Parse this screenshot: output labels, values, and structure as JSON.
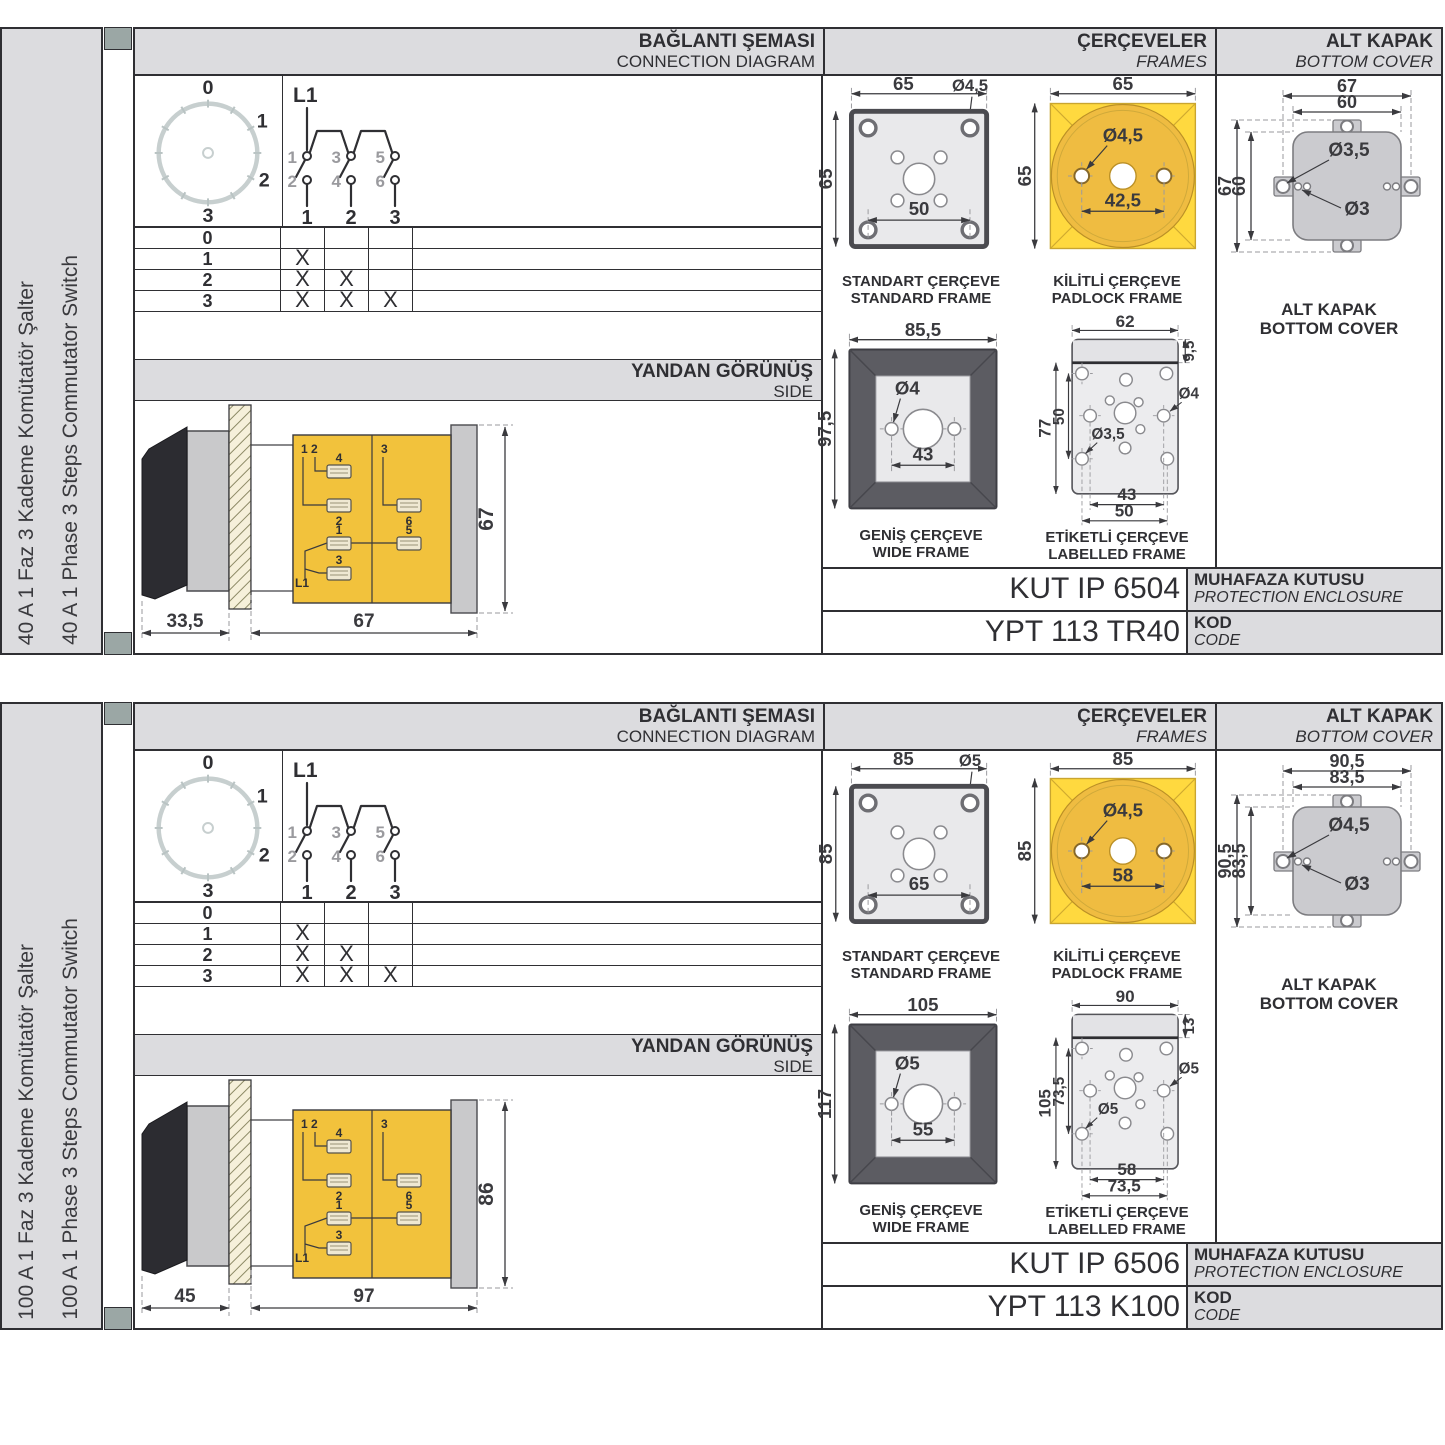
{
  "colors": {
    "accent_yellow": "#F2C23C",
    "padlock_yellow": "#FFD93F",
    "padlock_inner": "#EFBC41",
    "band_gray": "#DCDCDF",
    "line_dark": "#2F2F33",
    "wide_frame_dark": "#5C5C62",
    "corner_square": "#9BA7A5"
  },
  "p0": {
    "side_label_tr": "40 A 1 Faz 3 Kademe Komütatör Şalter",
    "side_label_en": "40 A 1 Phase 3 Steps Commutator Switch",
    "hdr": {
      "c1a": "BAĞLANTI ŞEMASI",
      "c1b": "CONNECTION DIAGRAM",
      "c2a": "ÇERÇEVELER",
      "c2b": "FRAMES",
      "c3a": "ALT KAPAK",
      "c3b": "BOTTOM COVER"
    },
    "dial": {
      "p0": "0",
      "p1": "1",
      "p2": "2",
      "p3": "3"
    },
    "sch": {
      "phase": "L1",
      "t1": "1",
      "t3": "3",
      "t5": "5",
      "b2": "2",
      "b4": "4",
      "b6": "6",
      "n1": "1",
      "n2": "2",
      "n3": "3"
    },
    "tbl": {
      "rows": [
        {
          "label": "0",
          "marks": [
            "",
            "",
            ""
          ]
        },
        {
          "label": "1",
          "marks": [
            "X",
            "",
            ""
          ]
        },
        {
          "label": "2",
          "marks": [
            "X",
            "X",
            ""
          ]
        },
        {
          "label": "3",
          "marks": [
            "X",
            "X",
            "X"
          ]
        }
      ]
    },
    "band": {
      "tr": "YANDAN GÖRÜNÜŞ",
      "en": "SIDE"
    },
    "sv": {
      "c12": "1 2",
      "c3": "3",
      "t4": "4",
      "t2": "2",
      "t1": "1",
      "t3": "3",
      "t6": "6",
      "t5": "5",
      "phase": "L1",
      "d_handle": "33,5",
      "d_body": "67",
      "d_height": "67"
    },
    "fr": {
      "std": {
        "w": "65",
        "h": "65",
        "hole": "Ø4,5",
        "pitch": "50",
        "cap1": "STANDART ÇERÇEVE",
        "cap2": "STANDARD FRAME"
      },
      "pad": {
        "w": "65",
        "h": "65",
        "hole": "Ø4,5",
        "pitch": "42,5",
        "cap1": "KİLİTLİ ÇERÇEVE",
        "cap2": "PADLOCK FRAME"
      },
      "wide": {
        "w": "85,5",
        "h": "97,5",
        "hole": "Ø4",
        "pitch": "43",
        "cap1": "GENİŞ ÇERÇEVE",
        "cap2": "WIDE FRAME"
      },
      "lab": {
        "w": "62",
        "band": "9,5",
        "h": "77",
        "pv": "50",
        "holeA": "Ø4",
        "holeB": "Ø3,5",
        "p1": "43",
        "p2": "50",
        "cap1": "ETİKETLİ ÇERÇEVE",
        "cap2": "LABELLED FRAME"
      }
    },
    "cov": {
      "ow": "67",
      "iw": "60",
      "oh": "67",
      "ih": "60",
      "holeA": "Ø3,5",
      "holeB": "Ø3",
      "cap1": "ALT KAPAK",
      "cap2": "BOTTOM COVER"
    },
    "enc": {
      "value": "KUT IP 6504",
      "l1": "MUHAFAZA KUTUSU",
      "l2": "PROTECTION ENCLOSURE"
    },
    "code": {
      "value": "YPT 113 TR40",
      "l1": "KOD",
      "l2": "CODE"
    }
  },
  "p1": {
    "side_label_tr": "100 A 1 Faz 3 Kademe Komütatör Şalter",
    "side_label_en": "100 A 1 Phase 3 Steps Commutator Switch",
    "hdr": {
      "c1a": "BAĞLANTI ŞEMASI",
      "c1b": "CONNECTION DIAGRAM",
      "c2a": "ÇERÇEVELER",
      "c2b": "FRAMES",
      "c3a": "ALT KAPAK",
      "c3b": "BOTTOM COVER"
    },
    "dial": {
      "p0": "0",
      "p1": "1",
      "p2": "2",
      "p3": "3"
    },
    "sch": {
      "phase": "L1",
      "t1": "1",
      "t3": "3",
      "t5": "5",
      "b2": "2",
      "b4": "4",
      "b6": "6",
      "n1": "1",
      "n2": "2",
      "n3": "3"
    },
    "tbl": {
      "rows": [
        {
          "label": "0",
          "marks": [
            "",
            "",
            ""
          ]
        },
        {
          "label": "1",
          "marks": [
            "X",
            "",
            ""
          ]
        },
        {
          "label": "2",
          "marks": [
            "X",
            "X",
            ""
          ]
        },
        {
          "label": "3",
          "marks": [
            "X",
            "X",
            "X"
          ]
        }
      ]
    },
    "band": {
      "tr": "YANDAN GÖRÜNÜŞ",
      "en": "SIDE"
    },
    "sv": {
      "c12": "1 2",
      "c3": "3",
      "t4": "4",
      "t2": "2",
      "t1": "1",
      "t3": "3",
      "t6": "6",
      "t5": "5",
      "phase": "L1",
      "d_handle": "45",
      "d_body": "97",
      "d_height": "86"
    },
    "fr": {
      "std": {
        "w": "85",
        "h": "85",
        "hole": "Ø5",
        "pitch": "65",
        "cap1": "STANDART ÇERÇEVE",
        "cap2": "STANDARD FRAME"
      },
      "pad": {
        "w": "85",
        "h": "85",
        "hole": "Ø4,5",
        "pitch": "58",
        "cap1": "KİLİTLİ ÇERÇEVE",
        "cap2": "PADLOCK FRAME"
      },
      "wide": {
        "w": "105",
        "h": "117",
        "hole": "Ø5",
        "pitch": "55",
        "cap1": "GENİŞ ÇERÇEVE",
        "cap2": "WIDE FRAME"
      },
      "lab": {
        "w": "90",
        "band": "13",
        "h": "105",
        "pv": "73,5",
        "holeA": "Ø5",
        "holeB": "Ø5",
        "p1": "58",
        "p2": "73,5",
        "cap1": "ETİKETLİ ÇERÇEVE",
        "cap2": "LABELLED FRAME"
      }
    },
    "cov": {
      "ow": "90,5",
      "iw": "83,5",
      "oh": "90,5",
      "ih": "83,5",
      "holeA": "Ø4,5",
      "holeB": "Ø3",
      "cap1": "ALT KAPAK",
      "cap2": "BOTTOM COVER"
    },
    "enc": {
      "value": "KUT IP 6506",
      "l1": "MUHAFAZA KUTUSU",
      "l2": "PROTECTION ENCLOSURE"
    },
    "code": {
      "value": "YPT 113 K100",
      "l1": "KOD",
      "l2": "CODE"
    }
  }
}
